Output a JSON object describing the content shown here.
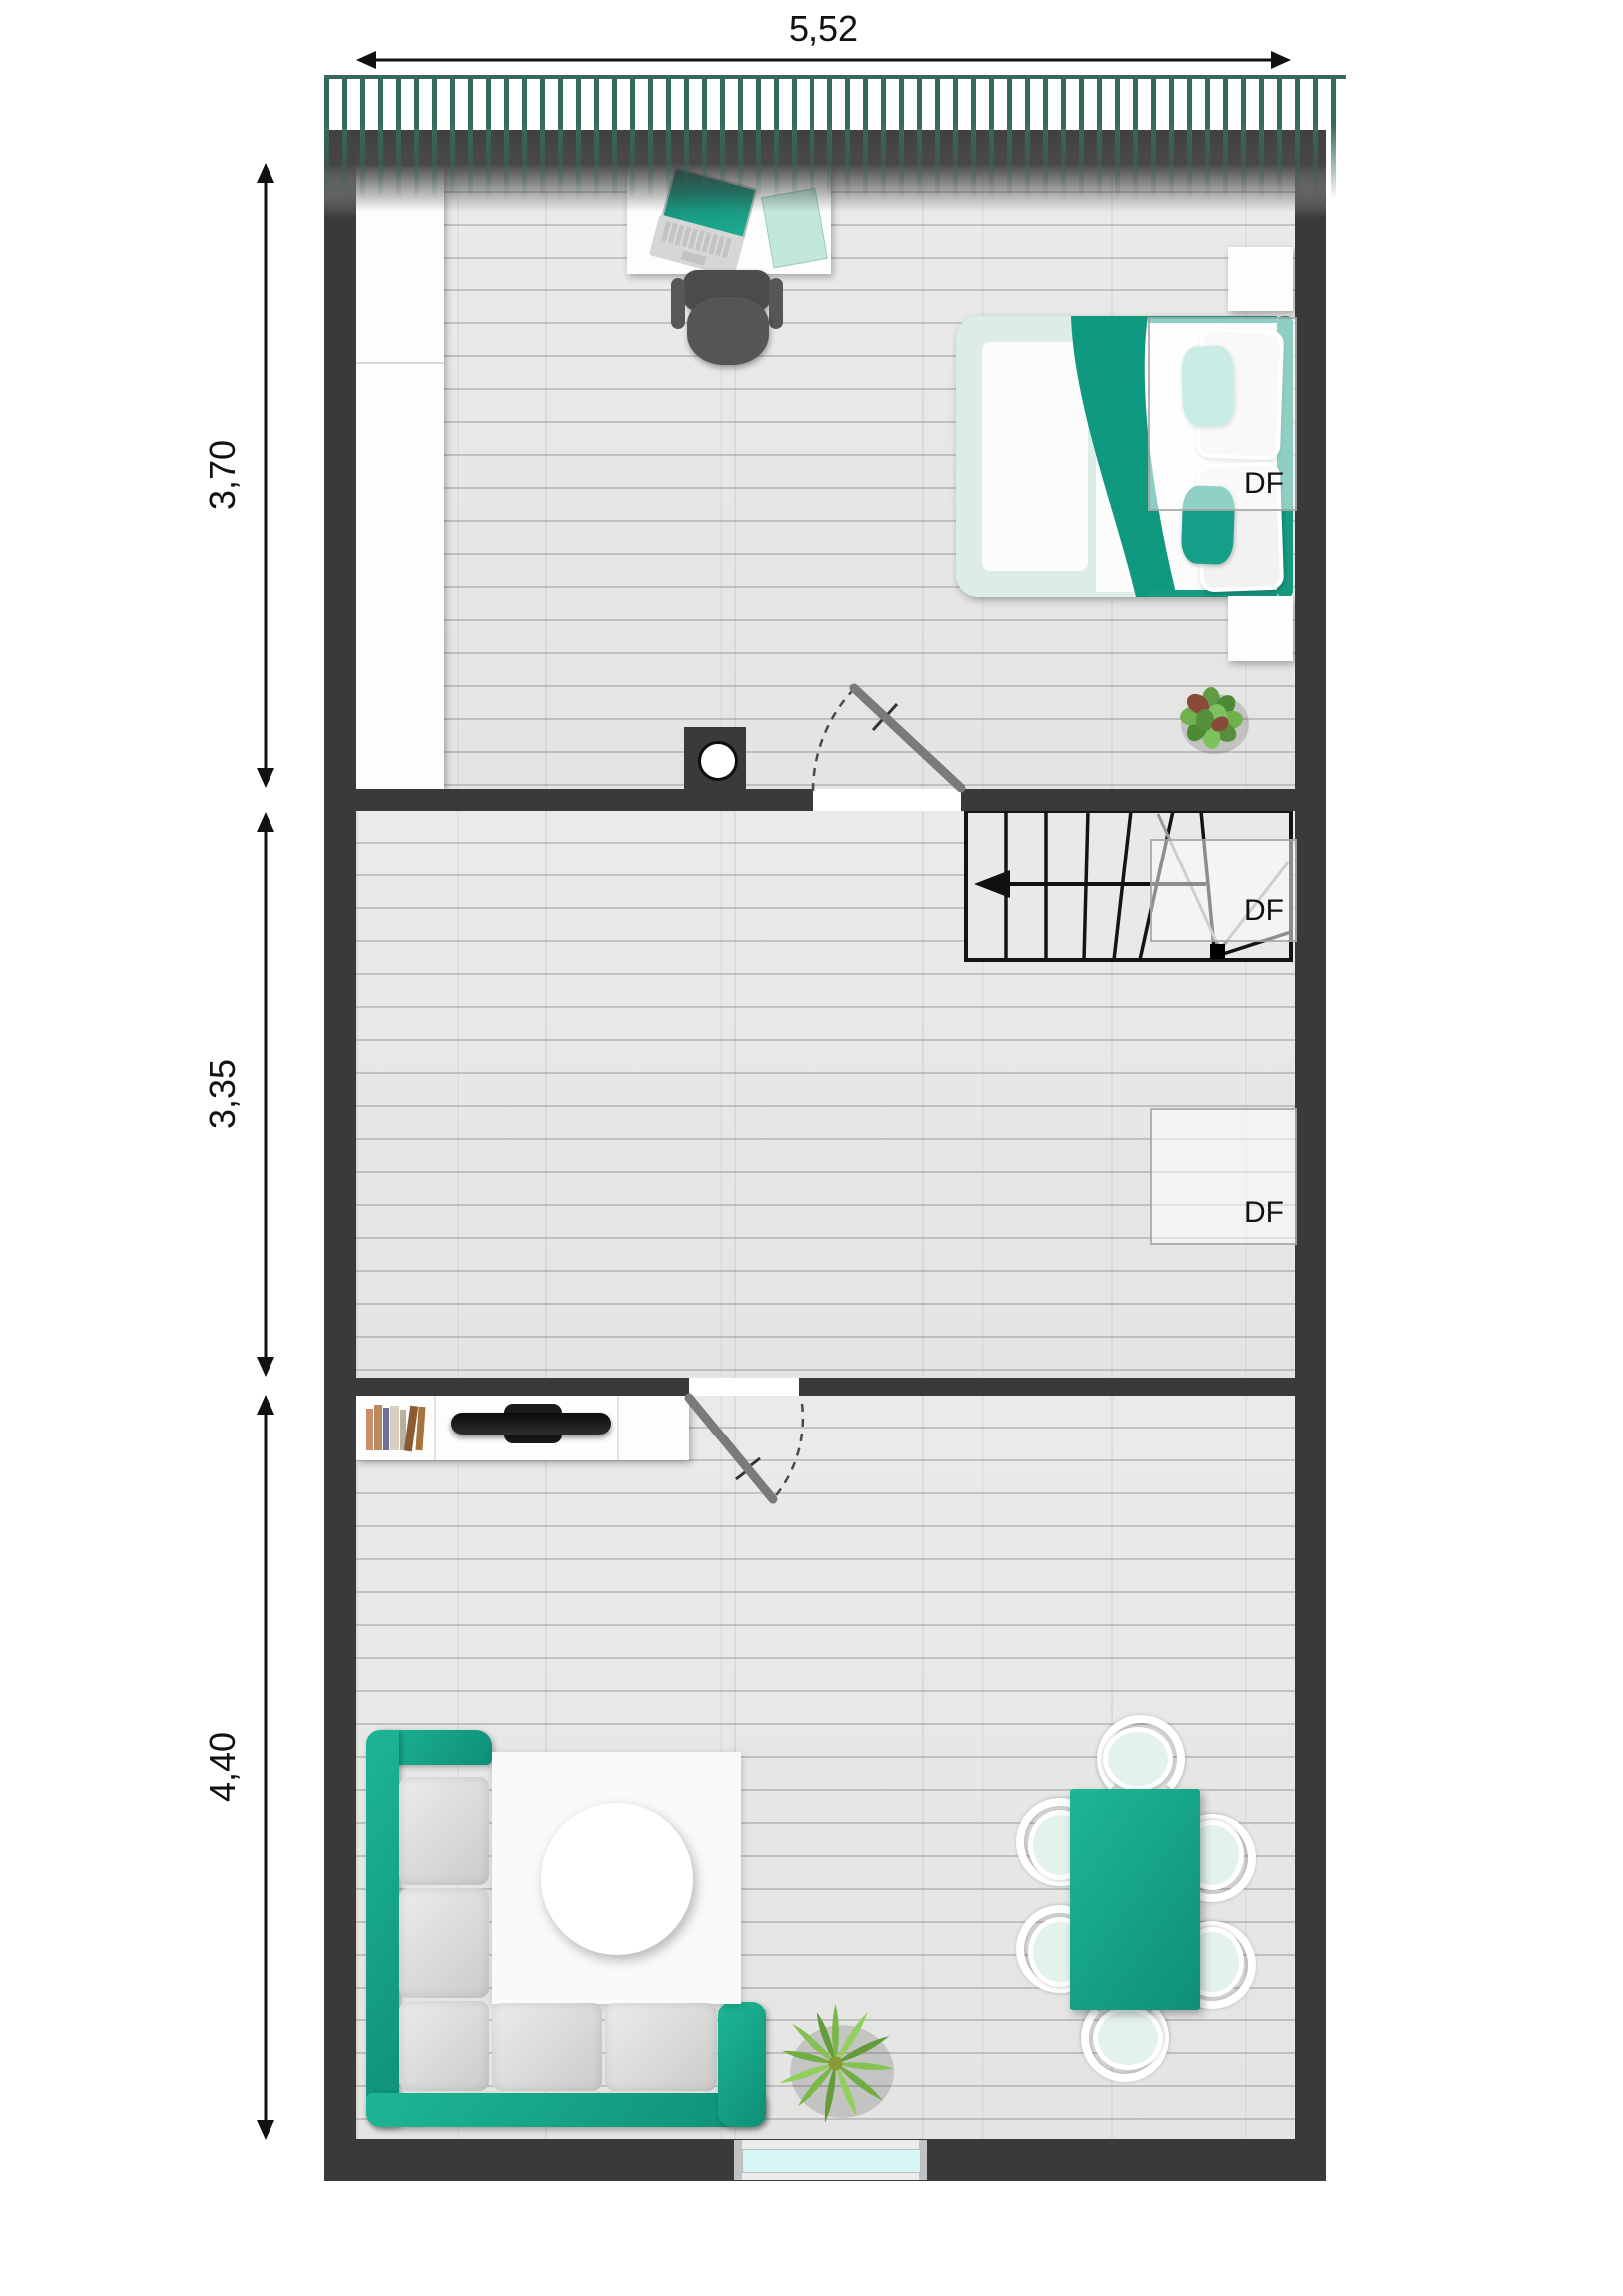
{
  "dimensions": {
    "width": {
      "label": "5,52"
    },
    "rooms": [
      {
        "name": "bedroom",
        "label": "3,70"
      },
      {
        "name": "hall",
        "label": "3,35"
      },
      {
        "name": "living-room",
        "label": "4,40"
      }
    ]
  },
  "skylights": [
    {
      "location": "bedroom",
      "label": "DF"
    },
    {
      "location": "stairs",
      "label": "DF"
    },
    {
      "location": "hall",
      "label": "DF"
    }
  ],
  "colors": {
    "accent": "#14a28a",
    "accent_dark": "#0e8f77",
    "accent_pale": "#8ed8c9",
    "wall": "#3a3a3a",
    "floor": "#e8e8e6",
    "skylight_hatch": "#35695e",
    "window_glass": "#d5f6f4"
  }
}
